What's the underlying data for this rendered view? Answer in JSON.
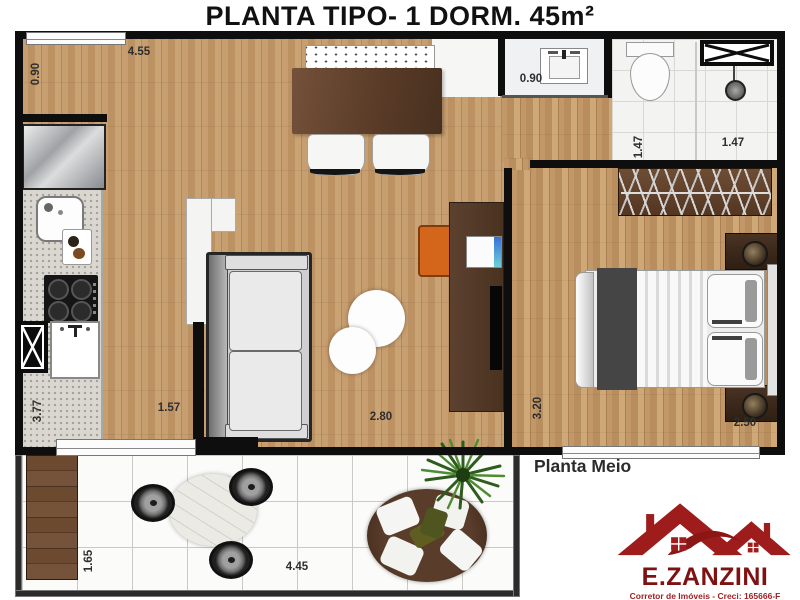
{
  "title": "PLANTA TIPO- 1 DORM. 45m²",
  "plan_label": "Planta Meio",
  "dims": {
    "top_width": "4.55",
    "entry_niche": "0.90",
    "bath_niche": "0.90",
    "bath_depth": "1.47",
    "bath_width": "1.47",
    "kitchen_length": "3.77",
    "living_left": "1.57",
    "living_width": "2.80",
    "bedroom_length": "3.20",
    "bedroom_width": "2.50",
    "balcony_depth": "1.65",
    "balcony_width": "4.45"
  },
  "logo": {
    "brand": "E.ZANZINI",
    "line1": "Corretor de Imóveis - Creci: 165666-F",
    "line2": "Zanzini Consultor de Investimentos Imobiliários"
  },
  "colors": {
    "wall": "#0e0e0e",
    "wood_floor": "#c49a6c",
    "dark_wood": "#5d4130",
    "logo_red": "#7e1212",
    "accent_orange": "#d4661c"
  }
}
